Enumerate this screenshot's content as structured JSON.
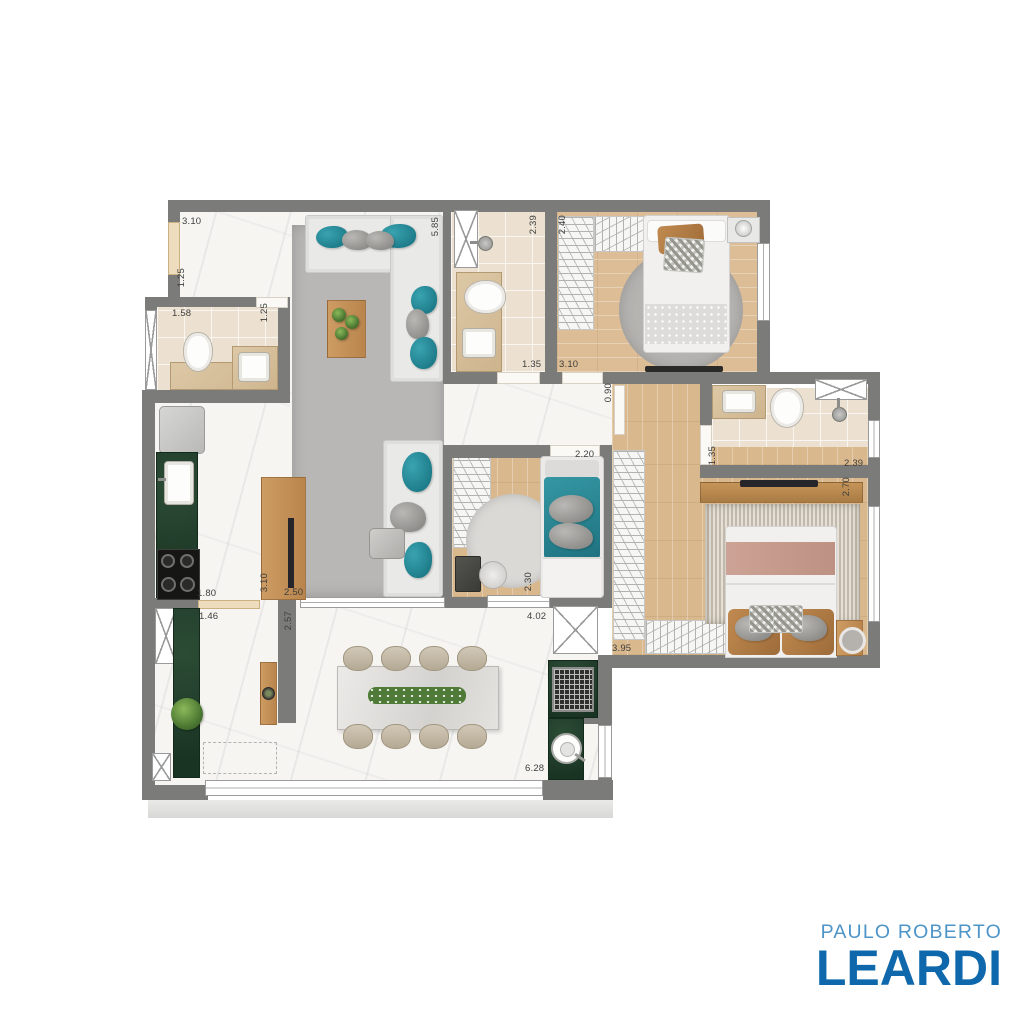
{
  "logo": {
    "line1": "PAULO ROBERTO",
    "line2": "LEARDI",
    "line1_color": "#4d95c8",
    "line2_color": "#0e68ab"
  },
  "palette": {
    "wall_gray": "#7b7b7a",
    "marble_floor": "#f6f5f2",
    "wood_floor": "#d9b88d",
    "bath_tile": "#ece1d0",
    "counter_green": "#21402c",
    "accent_teal": "#27899b",
    "rug_gray": "#b8b7b5",
    "logo_light_blue": "#4d95c8",
    "logo_dark_blue": "#0e68ab"
  },
  "furniture_icons": [
    "corner-sofa",
    "sofa",
    "coffee-table",
    "side-table",
    "tv-panel",
    "fridge",
    "kitchen-sink",
    "stove",
    "planter-counter",
    "bbq-grill",
    "bbq-sink",
    "dining-table",
    "dining-chair",
    "toilet",
    "bathroom-sink",
    "shower-head",
    "vent-shaft",
    "single-bed",
    "double-bed",
    "wardrobe-hangers",
    "round-rug",
    "nightstand",
    "desk",
    "chair",
    "pouf",
    "window",
    "door-opening"
  ],
  "dimensions": [
    {
      "text": "3.10",
      "x": 182,
      "y": 216,
      "vertical": false
    },
    {
      "text": "1.58",
      "x": 172,
      "y": 308,
      "vertical": false
    },
    {
      "text": "1.35",
      "x": 522,
      "y": 359,
      "vertical": false
    },
    {
      "text": "3.10",
      "x": 559,
      "y": 359,
      "vertical": false
    },
    {
      "text": "2.20",
      "x": 575,
      "y": 449,
      "vertical": false
    },
    {
      "text": "2.39",
      "x": 844,
      "y": 458,
      "vertical": false
    },
    {
      "text": "3.95",
      "x": 612,
      "y": 643,
      "vertical": false
    },
    {
      "text": "1.80",
      "x": 197,
      "y": 588,
      "vertical": false
    },
    {
      "text": "1.46",
      "x": 199,
      "y": 611,
      "vertical": false
    },
    {
      "text": "2.50",
      "x": 284,
      "y": 587,
      "vertical": false
    },
    {
      "text": "4.02",
      "x": 527,
      "y": 611,
      "vertical": false
    },
    {
      "text": "6.28",
      "x": 525,
      "y": 763,
      "vertical": false
    },
    {
      "text": "1.25",
      "x": 176,
      "y": 268,
      "vertical": true
    },
    {
      "text": "1.25",
      "x": 259,
      "y": 303,
      "vertical": true
    },
    {
      "text": "5.85",
      "x": 430,
      "y": 217,
      "vertical": true
    },
    {
      "text": "2.39",
      "x": 528,
      "y": 215,
      "vertical": true
    },
    {
      "text": "2.40",
      "x": 557,
      "y": 215,
      "vertical": true
    },
    {
      "text": "0.90",
      "x": 603,
      "y": 383,
      "vertical": true
    },
    {
      "text": "2.30",
      "x": 523,
      "y": 572,
      "vertical": true
    },
    {
      "text": "3.10",
      "x": 259,
      "y": 573,
      "vertical": true
    },
    {
      "text": "2.57",
      "x": 283,
      "y": 611,
      "vertical": true
    },
    {
      "text": "1.35",
      "x": 707,
      "y": 446,
      "vertical": true
    },
    {
      "text": "2.70",
      "x": 841,
      "y": 477,
      "vertical": true
    }
  ]
}
